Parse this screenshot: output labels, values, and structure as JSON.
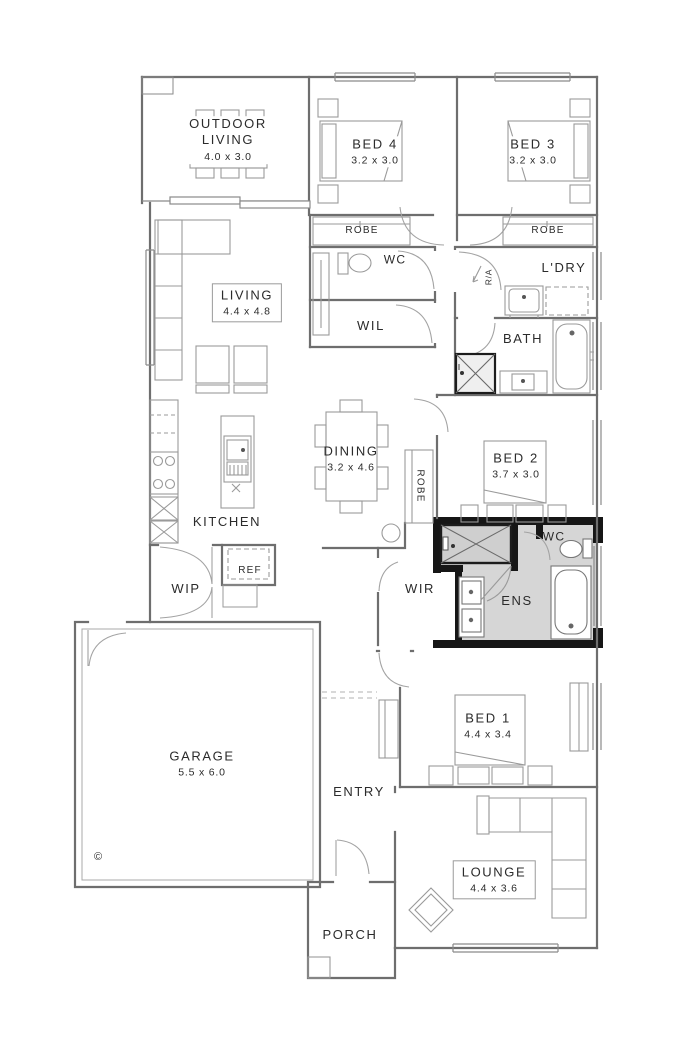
{
  "title": "Single storey house floor plan",
  "colors": {
    "background": "#ffffff",
    "wall_line": "#6e6e6e",
    "furniture_line": "#9a9a9a",
    "dark_wall": "#161616",
    "shaded_fill": "#d6d6d6",
    "text": "#2b2b2b"
  },
  "rooms": {
    "outdoor_living": {
      "label": "OUTDOOR LIVING",
      "dims": "4.0 x 3.0"
    },
    "bed4": {
      "label": "BED 4",
      "dims": "3.2 x 3.0"
    },
    "bed3": {
      "label": "BED 3",
      "dims": "3.2 x 3.0"
    },
    "robe_bed4": {
      "label": "ROBE"
    },
    "robe_bed3": {
      "label": "ROBE"
    },
    "wc_upper": {
      "label": "WC"
    },
    "laundry": {
      "label": "L'DRY"
    },
    "living": {
      "label": "LIVING",
      "dims": "4.4 x 4.8"
    },
    "wil": {
      "label": "WIL"
    },
    "bath": {
      "label": "BATH"
    },
    "dining": {
      "label": "DINING",
      "dims": "3.2 x 4.6"
    },
    "robe_bed2": {
      "label": "ROBE"
    },
    "bed2": {
      "label": "BED 2",
      "dims": "3.7 x 3.0"
    },
    "kitchen": {
      "label": "KITCHEN"
    },
    "wip": {
      "label": "WIP"
    },
    "ref": {
      "label": "REF"
    },
    "wir": {
      "label": "WIR"
    },
    "wc_ens": {
      "label": "WC"
    },
    "ens": {
      "label": "ENS"
    },
    "garage": {
      "label": "GARAGE",
      "dims": "5.5 x 6.0"
    },
    "entry": {
      "label": "ENTRY"
    },
    "bed1": {
      "label": "BED 1",
      "dims": "4.4 x 3.4"
    },
    "lounge": {
      "label": "LOUNGE",
      "dims": "4.4 x 3.6"
    },
    "porch": {
      "label": "PORCH"
    }
  },
  "annotations": {
    "return_air": "R/A",
    "copyright_mark": "©"
  }
}
